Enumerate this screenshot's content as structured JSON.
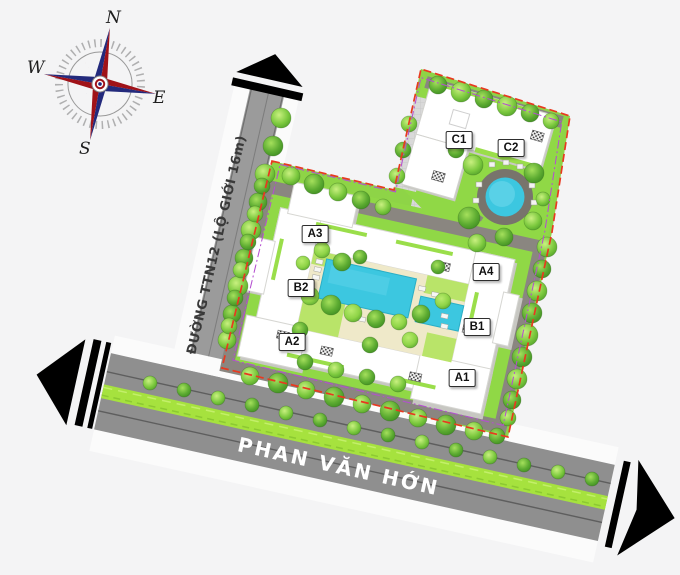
{
  "compass": {
    "north": "N",
    "east": "E",
    "south": "S",
    "west": "W"
  },
  "roads": {
    "ttn12_label": "ĐƯỜNG TTN12 (LỘ GIỚI 16m)",
    "phan_van_hon_label": "PHAN VĂN HỚN"
  },
  "buildings": {
    "a1": "A1",
    "a2": "A2",
    "a3": "A3",
    "a4": "A4",
    "b1": "B1",
    "b2": "B2",
    "c1": "C1",
    "c2": "C2"
  },
  "colors": {
    "background": "#f4f4f5",
    "boundary_line": "#e8391f",
    "setback_line": "#b44fd0",
    "road_asphalt": "#8f8f8f",
    "median_green": "#a6e23e",
    "grass": "#8ed447",
    "pool_water": "#3cc7e0",
    "courtyard_deck": "#efe9c9",
    "building": "#ffffff"
  }
}
